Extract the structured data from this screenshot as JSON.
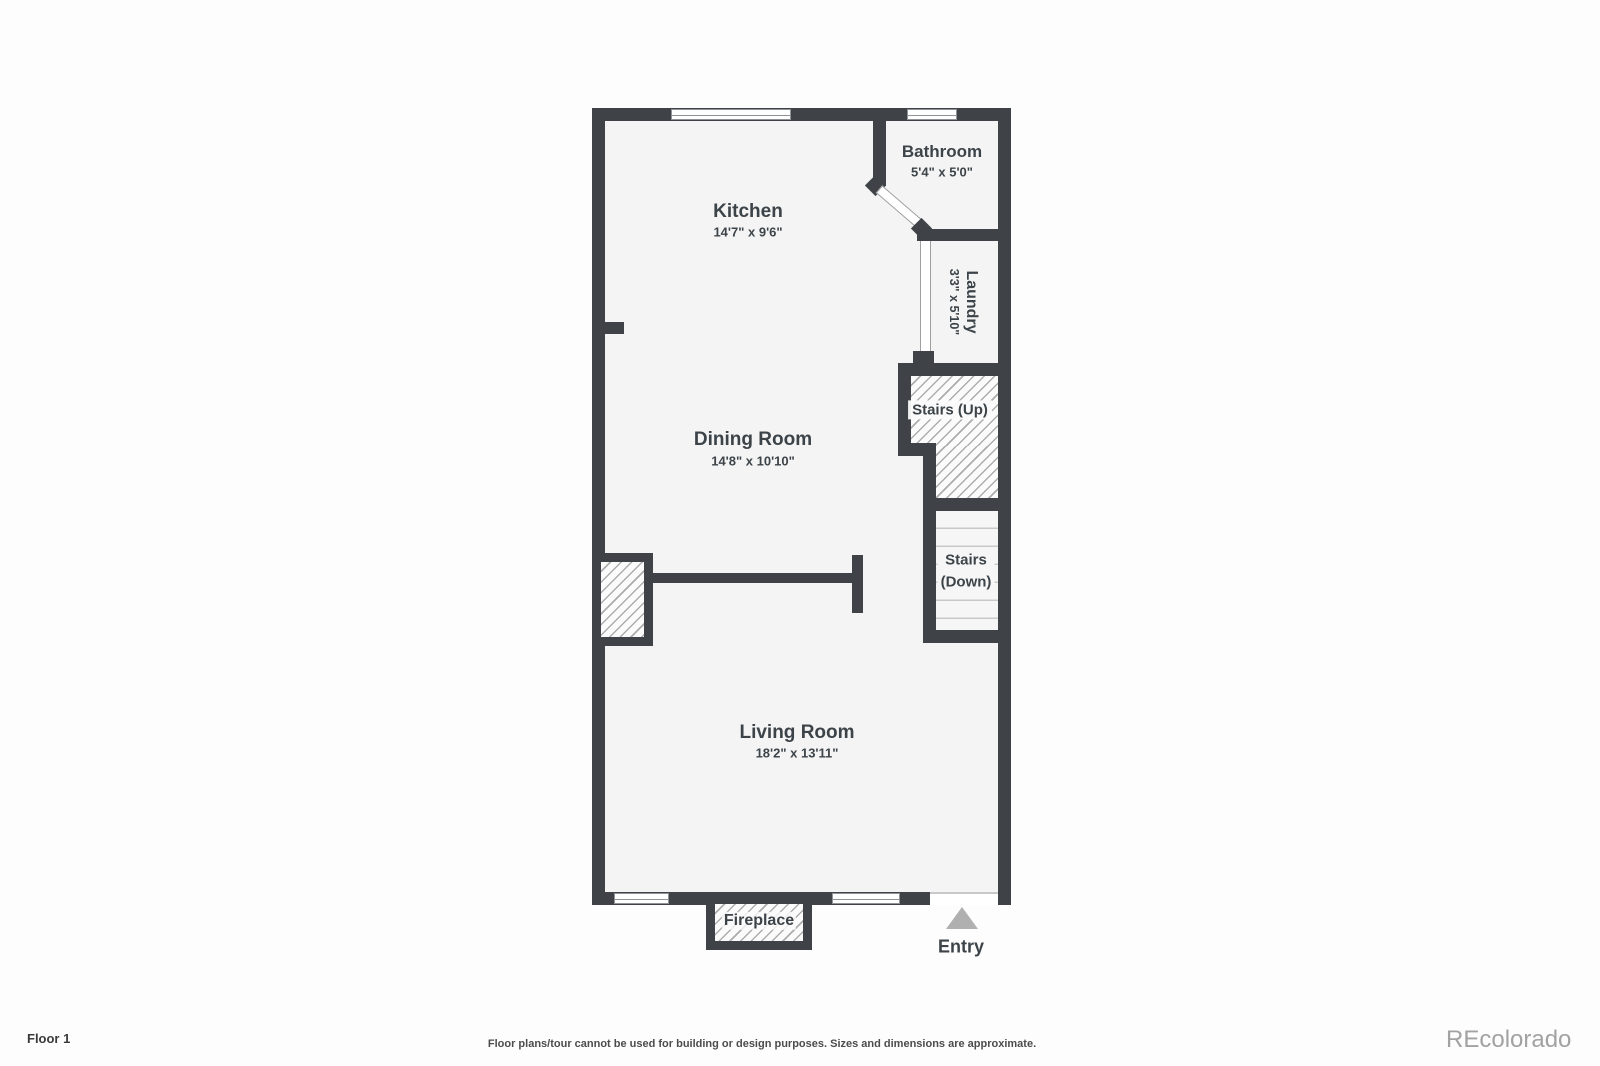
{
  "colors": {
    "wall": "#3f4347",
    "room_fill": "#f4f4f4",
    "hatch_line": "#adadad",
    "entry_arrow": "#b0b0b0",
    "text": "#3d4449",
    "watermark": "#a2a2a2"
  },
  "rooms": [
    {
      "name": "Kitchen",
      "dims": "14'7\" x 9'6\""
    },
    {
      "name": "Bathroom",
      "dims": "5'4\" x 5'0\""
    },
    {
      "name": "Laundry",
      "dims": "3'3\" x 5'10\""
    },
    {
      "name": "Dining Room",
      "dims": "14'8\" x 10'10\""
    },
    {
      "name": "Living Room",
      "dims": "18'2\" x 13'11\""
    }
  ],
  "features": {
    "stairs_up": "Stairs (Up)",
    "stairs_down_line1": "Stairs",
    "stairs_down_line2": "(Down)",
    "fireplace": "Fireplace",
    "entry": "Entry"
  },
  "footer": {
    "floor_label": "Floor 1",
    "disclaimer": "Floor plans/tour cannot be used for building or design purposes. Sizes and dimensions are approximate.",
    "watermark": "REcolorado"
  }
}
